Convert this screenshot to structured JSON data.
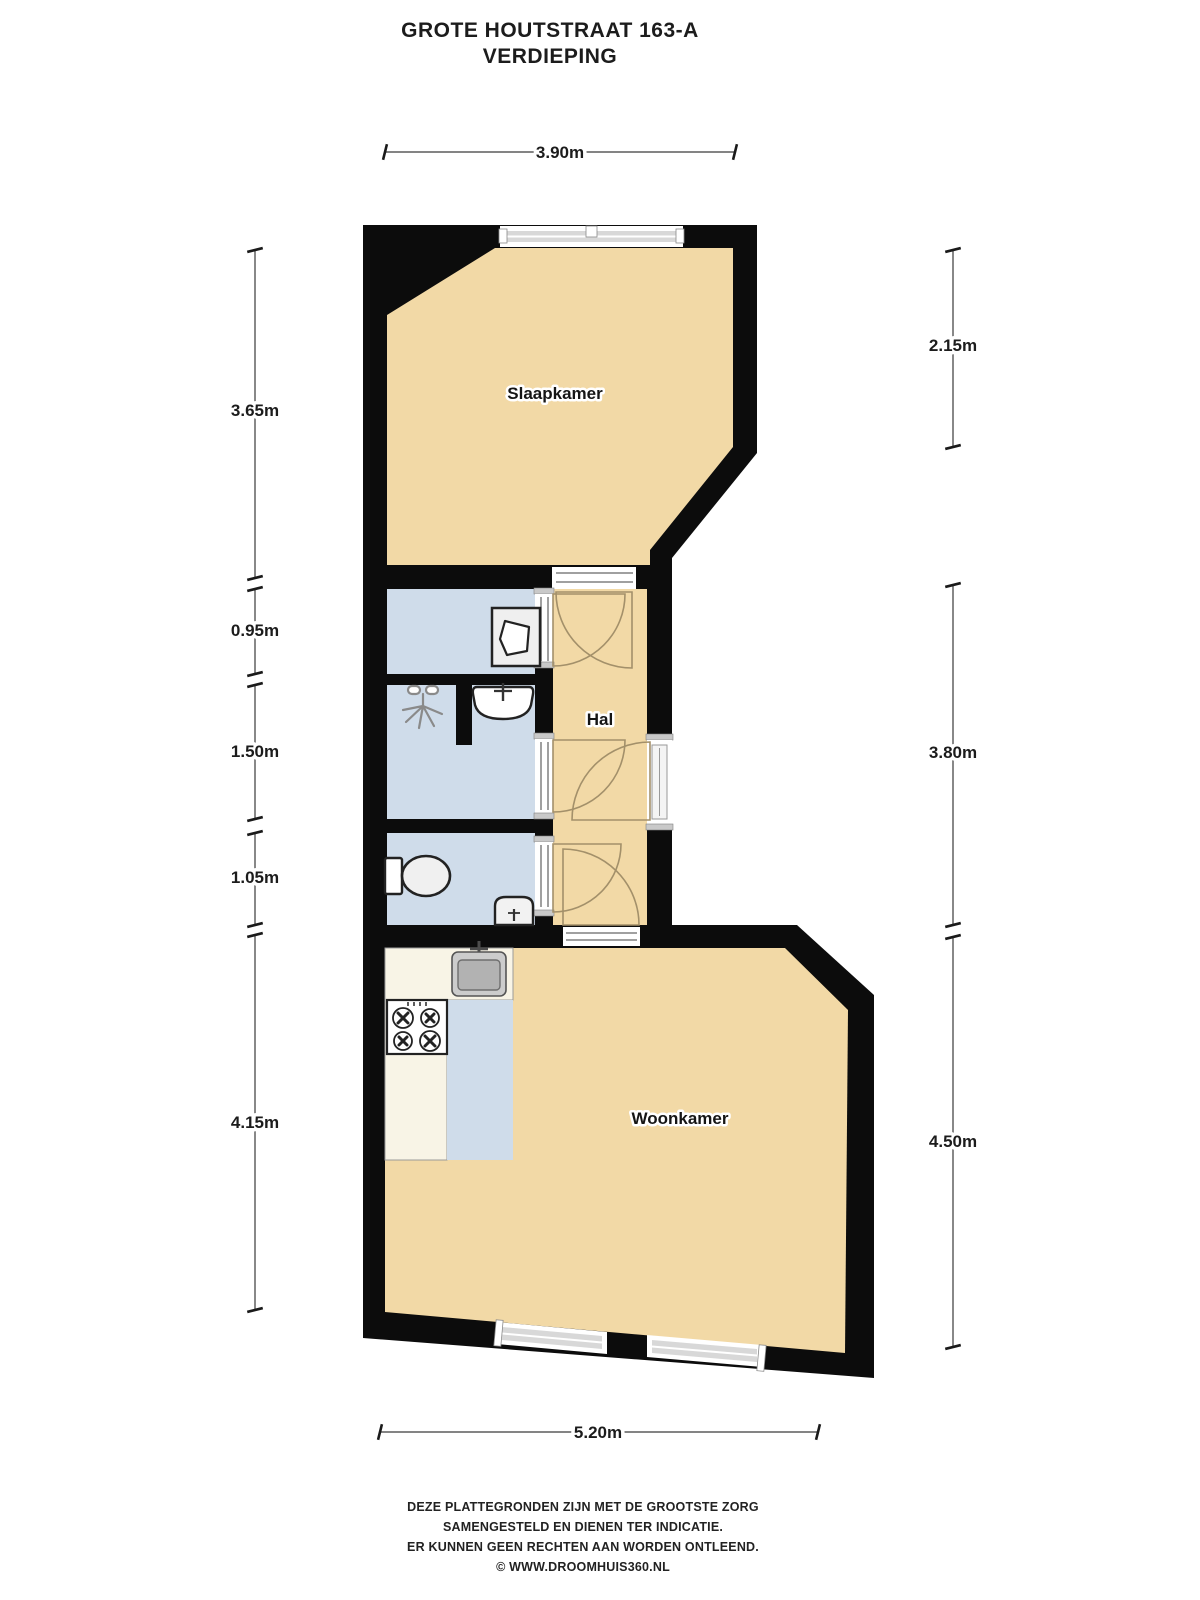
{
  "title": {
    "line1": "GROTE HOUTSTRAAT 163-A",
    "line2": "VERDIEPING"
  },
  "rooms": {
    "bedroom": "Slaapkamer",
    "hall": "Hal",
    "living": "Woonkamer"
  },
  "dimensions": {
    "top": "3.90m",
    "bottom": "5.20m",
    "left": [
      "3.65m",
      "0.95m",
      "1.50m",
      "1.05m",
      "4.15m"
    ],
    "right": [
      "2.15m",
      "3.80m",
      "4.50m"
    ]
  },
  "footer": {
    "line1": "DEZE PLATTEGRONDEN ZIJN MET DE GROOTSTE ZORG",
    "line2": "SAMENGESTELD EN DIENEN TER INDICATIE.",
    "line3": "ER KUNNEN GEEN RECHTEN AAN WORDEN ONTLEEND.",
    "line4": "© WWW.DROOMHUIS360.NL"
  },
  "icons": {
    "washing-machine-icon": "square with drum door",
    "shower-head-icon": "spray lines",
    "washbasin-icon": "rounded basin with faucet",
    "toilet-icon": "tank and bowl",
    "hand-basin-icon": "small corner basin",
    "kitchen-sink-icon": "metal sink with faucet",
    "stove-icon": "four gas burners",
    "window-icon": "double-line glazing band",
    "door-icon": "quarter-circle swing"
  },
  "colors": {
    "wall": "#0c0c0c",
    "floor": "#F2D9A6",
    "wet_room": "#CFDCEA",
    "counter": "#F8F4E6",
    "swing_arc": "#a3906a"
  }
}
